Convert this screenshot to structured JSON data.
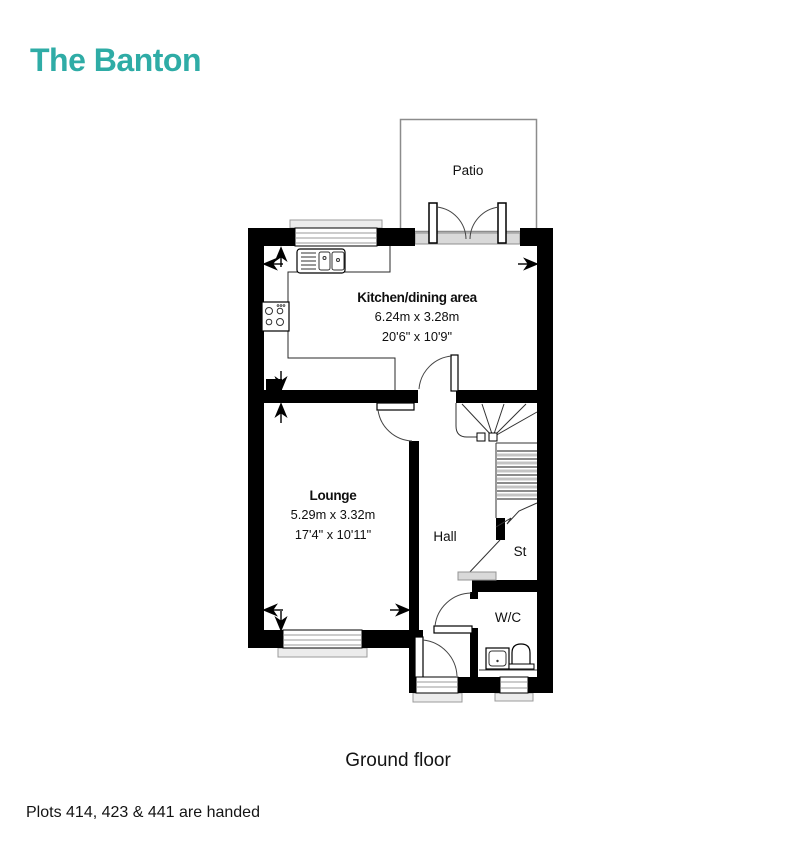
{
  "page": {
    "title": "The Banton",
    "floor_label": "Ground floor",
    "footnote": "Plots 414, 423 & 441 are handed",
    "accent_color": "#2FACA6"
  },
  "plan": {
    "rooms": {
      "patio": {
        "name": "Patio"
      },
      "kitchen": {
        "name": "Kitchen/dining area",
        "metric": "6.24m x 3.28m",
        "imperial": "20'6\" x 10'9\""
      },
      "lounge": {
        "name": "Lounge",
        "metric": "5.29m x 3.32m",
        "imperial": "17'4\" x 10'11\""
      },
      "hall": {
        "name": "Hall"
      },
      "store": {
        "name": "St"
      },
      "wc": {
        "name": "W/C"
      }
    },
    "fixtures": [
      "kitchen-sink-icon",
      "hob-icon",
      "stairs-icon",
      "basin-icon",
      "toilet-icon"
    ]
  }
}
